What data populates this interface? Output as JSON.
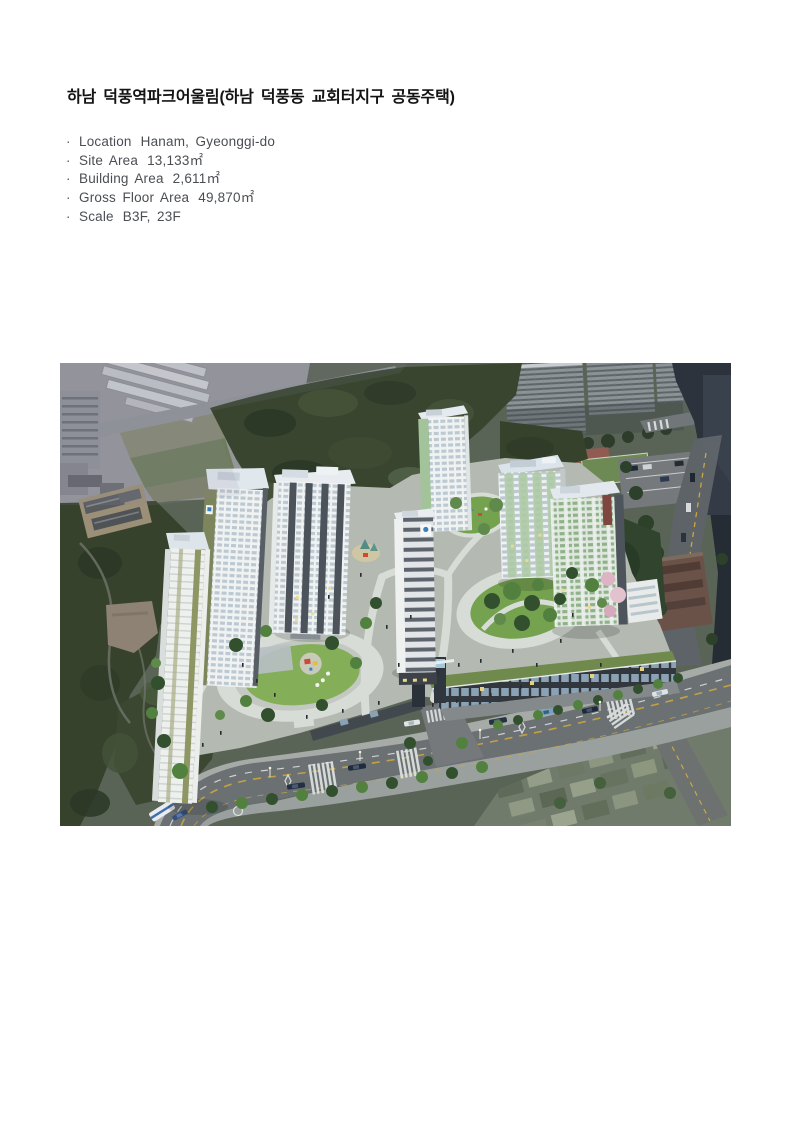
{
  "title": "하남 덕풍역파크어울림(하남 덕풍동 교회터지구 공동주택)",
  "specs": {
    "bullet": "·",
    "items": [
      {
        "label": "Location",
        "value": "Hanam, Gyeonggi-do"
      },
      {
        "label": "Site Area",
        "value": "13,133㎡"
      },
      {
        "label": "Building Area",
        "value": "2,611㎡"
      },
      {
        "label": "Gross Floor Area",
        "value": "49,870㎡"
      },
      {
        "label": "Scale",
        "value": "B3F, 23F"
      }
    ]
  },
  "figure": {
    "alt": "Aerial rendering of the Hanam Deokpung-dong apartment complex: seven white residential towers with green glass accents around landscaped circular parks, a commercial podium and entrance gate along a main boulevard, surrounded by forest, an existing apartment estate and a low-rise neighborhood",
    "palette": {
      "forest": "#39452f",
      "tower_white": "#f1f3f2",
      "tower_roof": "#dde4ea",
      "accent_olive": "#7d8659",
      "green_glass": "#9dbd97",
      "road": "#6b7073",
      "lawn": "#7fae57",
      "existing_gray": "#8d9497"
    }
  }
}
